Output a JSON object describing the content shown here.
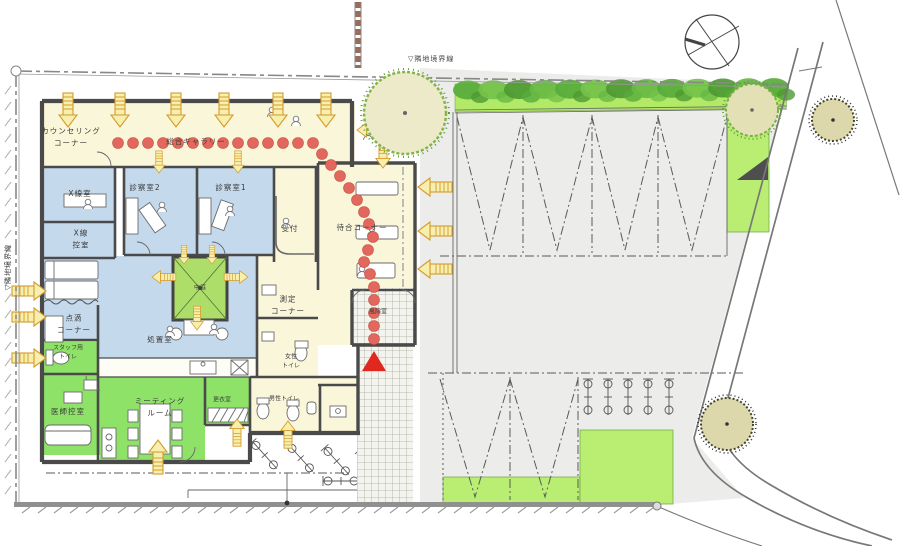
{
  "drawing": {
    "type": "clinic-site-floor-plan",
    "boundary": {
      "left_label": "▽隣地境界線",
      "top_label": "▽隣地境界線"
    },
    "rooms": {
      "counseling": {
        "line1": "カウンセリング",
        "line2": "コーナー"
      },
      "gallery": {
        "label": "総合ギャラリー"
      },
      "xray_room": {
        "label": "X線室"
      },
      "xray_anteroom": {
        "line1": "X線",
        "line2": "控室"
      },
      "exam_room_2": {
        "label": "診察室2"
      },
      "exam_room_1": {
        "label": "診察室1"
      },
      "reception": {
        "label": "受付"
      },
      "waiting_corner": {
        "label": "待合コーナー"
      },
      "iv_corner": {
        "line1": "点滴",
        "line2": "コーナー"
      },
      "treatment_room": {
        "label": "処置室"
      },
      "courtyard": {
        "label": "中庭"
      },
      "measuring_corner": {
        "line1": "測定",
        "line2": "コーナー"
      },
      "womens_toilet": {
        "line1": "女性",
        "line2": "トイレ"
      },
      "vestibule": {
        "label": "風除室"
      },
      "staff_toilet": {
        "line1": "スタッフ用",
        "line2": "トイレ"
      },
      "doctors_lounge": {
        "label": "医師控室"
      },
      "meeting_room": {
        "line1": "ミーティング",
        "line2": "ルーム"
      },
      "changing_room": {
        "label": "更衣室"
      },
      "mens_toilet": {
        "label": "男性トイレ"
      }
    },
    "colors": {
      "room_cream": "#faf6da",
      "room_blue": "#c4d9ec",
      "room_green": "#8fe268",
      "courtyard_green": "#aede6a",
      "lawn_green": "#b9ee72",
      "hedge_green": "#b2e966",
      "parking_gray": "#ececea",
      "wall_gray": "#4a4a4a",
      "flow_dot_red": "#e2675c",
      "arrow_yellow": "#f7efae",
      "arrow_outline": "#d59b2c",
      "entrance_marker_red": "#e0281e",
      "road_line_gray": "#777777"
    },
    "icons": {
      "north_arrow": "compass-circle",
      "trees": 4,
      "bicycle_symbols": 10
    }
  }
}
